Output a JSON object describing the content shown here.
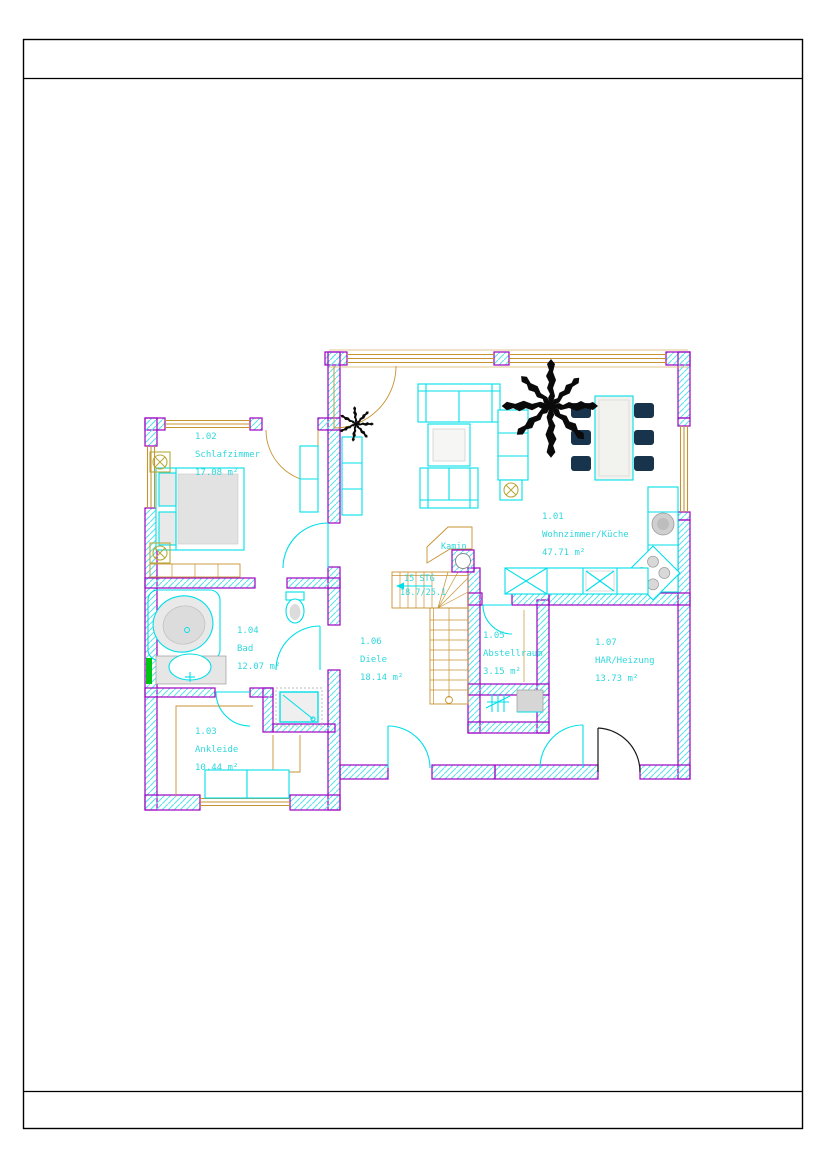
{
  "sheet": {
    "type": "architectural-floor-plan"
  },
  "rooms": [
    {
      "id": "1.01",
      "name": "Wohnzimmer/Küche",
      "area": "47.71 m²"
    },
    {
      "id": "1.02",
      "name": "Schlafzimmer",
      "area": "17.08 m²"
    },
    {
      "id": "1.03",
      "name": "Ankleide",
      "area": "10.44 m²"
    },
    {
      "id": "1.04",
      "name": "Bad",
      "area": "12.07 m²"
    },
    {
      "id": "1.05",
      "name": "Abstellraum",
      "area": "3.15 m²"
    },
    {
      "id": "1.06",
      "name": "Diele",
      "area": "18.14 m²"
    },
    {
      "id": "1.07",
      "name": "HAR/Heizung",
      "area": "13.73 m²"
    }
  ],
  "stairs": {
    "steps_label": "15 STG",
    "dimensions_label": "18.7/25.1"
  },
  "fireplace": {
    "label": "Kamin"
  },
  "colors": {
    "wall_outline": "#9e00c0",
    "wall_hatch": "#5fe2ec",
    "furniture": "#00dfe8",
    "wood_windows": "#c79232",
    "room_labels": "#2fd8dc",
    "dining_chairs": "#18344c",
    "lamp_symbol": "#b9a93a",
    "radiator_green": "#00c414",
    "entrance_door": "#1a1a1a",
    "sheet_frame": "#000000"
  }
}
